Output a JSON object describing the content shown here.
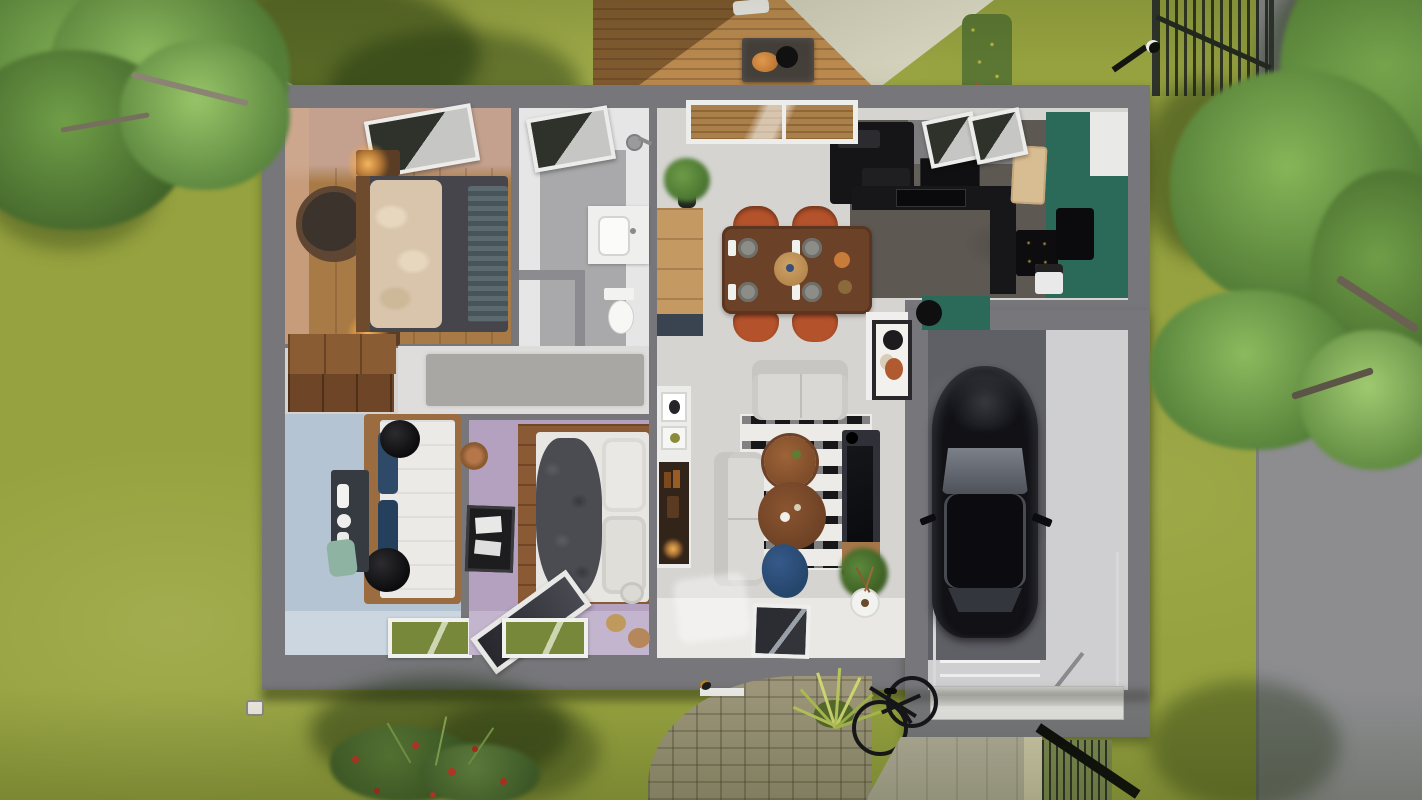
{
  "scene": {
    "type": "3d-floor-plan-top-view",
    "description": "Top-down 3D render of a single-storey house with attached garage, lawn with two large trees, rear wood deck with shade sail, paver path, bicycle and street on the right"
  },
  "colors": {
    "grass": "#96a23f",
    "road": "#8d8d90",
    "wall": "#77777b",
    "wall-inner": "#8b8b90",
    "deck-wood": "#b9894e",
    "deck-wood-dark": "#9c7040",
    "sail": "#d9d6c2",
    "room-floor-light": "#d5d4d1",
    "master-floor": "#a87a45",
    "master-wall": "#c4a18f",
    "bath-floor": "#a9a9ab",
    "bath-wall": "#e6e6e6",
    "blue-floor": "#b5c4d3",
    "purple-floor": "#b3a1bf",
    "hall-floor": "#dedddb",
    "kitchen-floor": "#5d5852",
    "teal": "#2b6a58",
    "counter-black": "#17171a",
    "dining-table": "#6b4227",
    "chair-rust": "#b4522b",
    "sofa": "#d9d8d5",
    "rug-black": "#17171a",
    "rug-white": "#ecebe7",
    "tv-dark": "#303138",
    "pouf-blue": "#25466b",
    "garage-floor-dark": "#5f5f66",
    "garage-floor-light": "#cfcfd2",
    "car-black": "#121216",
    "car-glass": "#70747c",
    "door-white": "#e4e4e2",
    "cobble": "#9c9579",
    "driveway": "#b2ad99",
    "bed-duvet-dark": "#45454b",
    "pillow-beige": "#d8c5ac",
    "bed-white": "#eceae6",
    "pillow-navy": "#2e4a68",
    "wood-cabinet": "#8a5c34",
    "wood-cabinet-dark": "#6e4526",
    "tree-foliage": "#557f38",
    "tree-foliage-light": "#7fae54"
  },
  "elements": {
    "rooms": [
      "master-bedroom",
      "bathroom",
      "wc",
      "hallway",
      "closet",
      "bedroom-blue",
      "bedroom-purple",
      "open-kitchen-dining-living",
      "entry",
      "garage"
    ],
    "furniture": [
      "double-bed",
      "bedside-lamps",
      "round-side-table",
      "wardrobe",
      "skylights",
      "shower",
      "vanity-sink",
      "toilet",
      "single-bed-blue",
      "desk",
      "single-bed-purple",
      "leaning-mirror",
      "wall-art",
      "dining-table",
      "dining-chairs",
      "sideboard",
      "kitchen-counter",
      "cooktop",
      "fridge",
      "coffee-machine",
      "sofa",
      "loveseat",
      "coffee-tables",
      "tv-console",
      "area-rug",
      "ottoman",
      "console-shelf",
      "decor-vase",
      "house-plants",
      "car",
      "garage-door"
    ],
    "exterior": [
      "lawn",
      "street",
      "big-tree-left",
      "big-tree-right",
      "wood-deck",
      "shade-sail",
      "bbq-grill",
      "flower-bed",
      "garden-gate",
      "street-lamps",
      "paver-path",
      "ornamental-grass",
      "bicycle",
      "driveway",
      "slat-fence",
      "rose-bush",
      "bedroom-windows"
    ]
  }
}
